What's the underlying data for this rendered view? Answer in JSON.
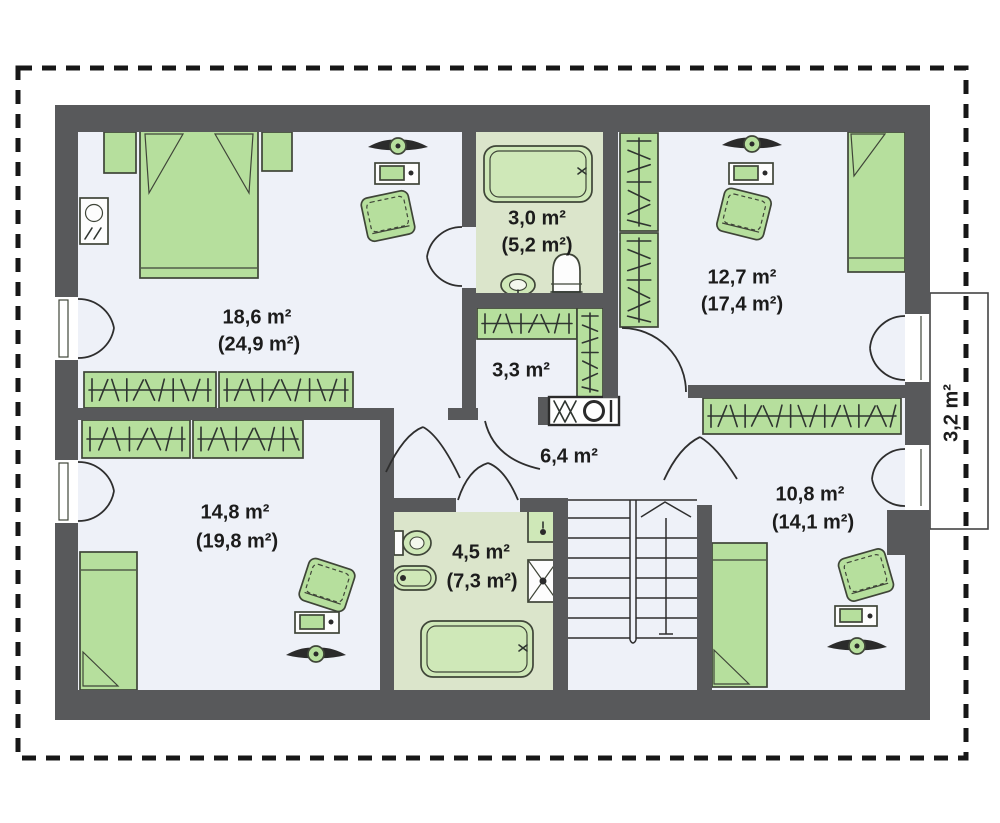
{
  "plan": {
    "title": "attic-floor-plan",
    "colors": {
      "wall": "#58595b",
      "room_floor": "#eef1f8",
      "bathroom_floor": "#dbe5cb",
      "furniture": "#b6df9d",
      "outline": "#2e2e2e",
      "dashed_border": "#171717"
    },
    "rooms": [
      {
        "id": "bedroom-top-left",
        "area": "18,6 m²",
        "area_total": "(24,9 m²)"
      },
      {
        "id": "bathroom-top",
        "area": "3,0 m²",
        "area_total": "(5,2 m²)"
      },
      {
        "id": "bedroom-top-right",
        "area": "12,7 m²",
        "area_total": "(17,4 m²)"
      },
      {
        "id": "wardrobe-room",
        "area": "3,3 m²",
        "area_total": ""
      },
      {
        "id": "hallway",
        "area": "6,4 m²",
        "area_total": ""
      },
      {
        "id": "bedroom-bottom-left",
        "area": "14,8 m²",
        "area_total": "(19,8 m²)"
      },
      {
        "id": "bathroom-bottom",
        "area": "4,5 m²",
        "area_total": "(7,3 m²)"
      },
      {
        "id": "bedroom-bottom-right",
        "area": "10,8 m²",
        "area_total": "(14,1 m²)"
      },
      {
        "id": "balcony",
        "area": "3,2 m²",
        "area_total": ""
      }
    ]
  }
}
